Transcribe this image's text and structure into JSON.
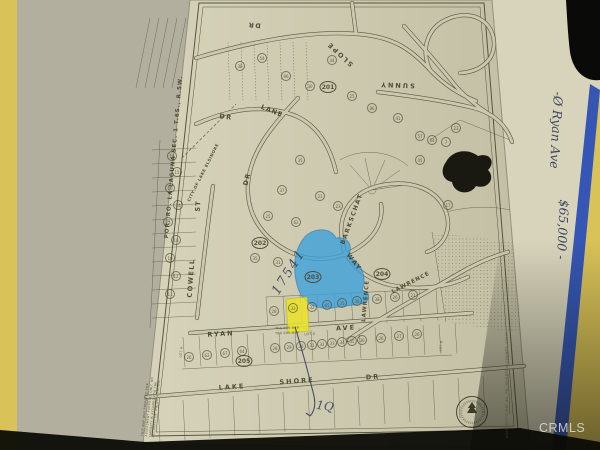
{
  "photo": {
    "watermark": "CRMLS",
    "left_folder_color": "#d9c258",
    "blue_stripe_color": "#3556b4",
    "paper_color": "#ccc9ae",
    "highlight_blue": "#37a0dc",
    "highlight_yellow": "#e8e02e",
    "map_ink_color": "#57553e",
    "pen_color": "#39405c"
  },
  "map": {
    "edge_title": "POR. RO. LA LAGUNA SEC. 1 T.6S., R.5W.",
    "city_boundary": "CITY OF LAKE ELSINORE",
    "streets": [
      {
        "label": "DR"
      },
      {
        "label": "SLOPE"
      },
      {
        "label": "SUNNY"
      },
      {
        "label": "DR"
      },
      {
        "label": "LANE"
      },
      {
        "label": "DR"
      },
      {
        "label": "BARKSCHAT"
      },
      {
        "label": "WAY"
      },
      {
        "label": "LAWRENCE"
      },
      {
        "label": "LAWRENCE"
      },
      {
        "label": "RYAN"
      },
      {
        "label": "AVE"
      },
      {
        "label": "LAKE"
      },
      {
        "label": "SHORE"
      },
      {
        "label": "DR"
      },
      {
        "label": "COWELL"
      },
      {
        "label": "ST"
      }
    ],
    "blocks": [
      {
        "n": "201",
        "x": 328,
        "y": 87
      },
      {
        "n": "202",
        "x": 260,
        "y": 243
      },
      {
        "n": "203",
        "x": 313,
        "y": 277
      },
      {
        "n": "204",
        "x": 382,
        "y": 274
      },
      {
        "n": "205",
        "x": 244,
        "y": 361
      }
    ],
    "lots": [
      {
        "n": "54",
        "x": 262,
        "y": 58
      },
      {
        "n": "38",
        "x": 240,
        "y": 66
      },
      {
        "n": "96",
        "x": 286,
        "y": 76
      },
      {
        "n": "30",
        "x": 310,
        "y": 86
      },
      {
        "n": "44",
        "x": 332,
        "y": 60
      },
      {
        "n": "25",
        "x": 352,
        "y": 96
      },
      {
        "n": "86",
        "x": 372,
        "y": 108
      },
      {
        "n": "41",
        "x": 398,
        "y": 118
      },
      {
        "n": "57",
        "x": 420,
        "y": 136
      },
      {
        "n": "7",
        "x": 446,
        "y": 142
      },
      {
        "n": "35",
        "x": 300,
        "y": 160
      },
      {
        "n": "37",
        "x": 282,
        "y": 190
      },
      {
        "n": "21",
        "x": 320,
        "y": 196
      },
      {
        "n": "23",
        "x": 338,
        "y": 206
      },
      {
        "n": "25",
        "x": 268,
        "y": 216
      },
      {
        "n": "62",
        "x": 296,
        "y": 222
      },
      {
        "n": "35",
        "x": 255,
        "y": 258
      },
      {
        "n": "31",
        "x": 278,
        "y": 262
      },
      {
        "n": "18",
        "x": 172,
        "y": 156
      },
      {
        "n": "15",
        "x": 177,
        "y": 172
      },
      {
        "n": "19",
        "x": 170,
        "y": 188
      },
      {
        "n": "14",
        "x": 178,
        "y": 205
      },
      {
        "n": "22",
        "x": 168,
        "y": 222
      },
      {
        "n": "16",
        "x": 176,
        "y": 240
      },
      {
        "n": "10",
        "x": 170,
        "y": 258
      },
      {
        "n": "12",
        "x": 176,
        "y": 276
      },
      {
        "n": "11",
        "x": 170,
        "y": 294
      },
      {
        "n": "64",
        "x": 432,
        "y": 140
      },
      {
        "n": "23",
        "x": 456,
        "y": 128
      },
      {
        "n": "45",
        "x": 420,
        "y": 160
      },
      {
        "n": "17",
        "x": 448,
        "y": 205
      },
      {
        "n": "28",
        "x": 274,
        "y": 311
      },
      {
        "n": "33",
        "x": 293,
        "y": 308
      },
      {
        "n": "32",
        "x": 312,
        "y": 307
      },
      {
        "n": "65",
        "x": 327,
        "y": 305
      },
      {
        "n": "35",
        "x": 342,
        "y": 303
      },
      {
        "n": "36",
        "x": 357,
        "y": 301
      },
      {
        "n": "38",
        "x": 377,
        "y": 299
      },
      {
        "n": "26",
        "x": 395,
        "y": 297
      },
      {
        "n": "21",
        "x": 413,
        "y": 295
      },
      {
        "n": "26",
        "x": 189,
        "y": 357
      },
      {
        "n": "62",
        "x": 207,
        "y": 355
      },
      {
        "n": "67",
        "x": 225,
        "y": 353
      },
      {
        "n": "64",
        "x": 242,
        "y": 351
      },
      {
        "n": "28",
        "x": 275,
        "y": 348
      },
      {
        "n": "29",
        "x": 289,
        "y": 347
      },
      {
        "n": "30",
        "x": 301,
        "y": 346
      },
      {
        "n": "31",
        "x": 312,
        "y": 345
      },
      {
        "n": "32",
        "x": 322,
        "y": 344
      },
      {
        "n": "33",
        "x": 332,
        "y": 343
      },
      {
        "n": "34",
        "x": 342,
        "y": 342
      },
      {
        "n": "35",
        "x": 352,
        "y": 341
      },
      {
        "n": "36",
        "x": 362,
        "y": 340
      },
      {
        "n": "26",
        "x": 381,
        "y": 338
      },
      {
        "n": "27",
        "x": 399,
        "y": 336
      },
      {
        "n": "26",
        "x": 417,
        "y": 334
      }
    ],
    "small_texts": {
      "tra1": "TRA 005-009",
      "tra2": "TRA 005-039",
      "lot_g": "LOT G",
      "lot_a": "LOT A",
      "lot_b": "LOT B"
    },
    "disclaimer": "THIS MAP WAS PREPARED FOR ASSESSMENT PURPOSES ONLY. NO LIABILITY IS ASSUMED FOR THE ACCURACY OF THE DATA SHOWN.",
    "assessor_note": "ASSESSOR'S MAP BK. PG. RIVERSIDE COUNTY, CALIF.",
    "handwriting": {
      "parcel_number": "17541",
      "lot_note": "1Q",
      "margin_line1": "-Ø Ryan Ave",
      "margin_line2": "$65,000 -"
    }
  }
}
